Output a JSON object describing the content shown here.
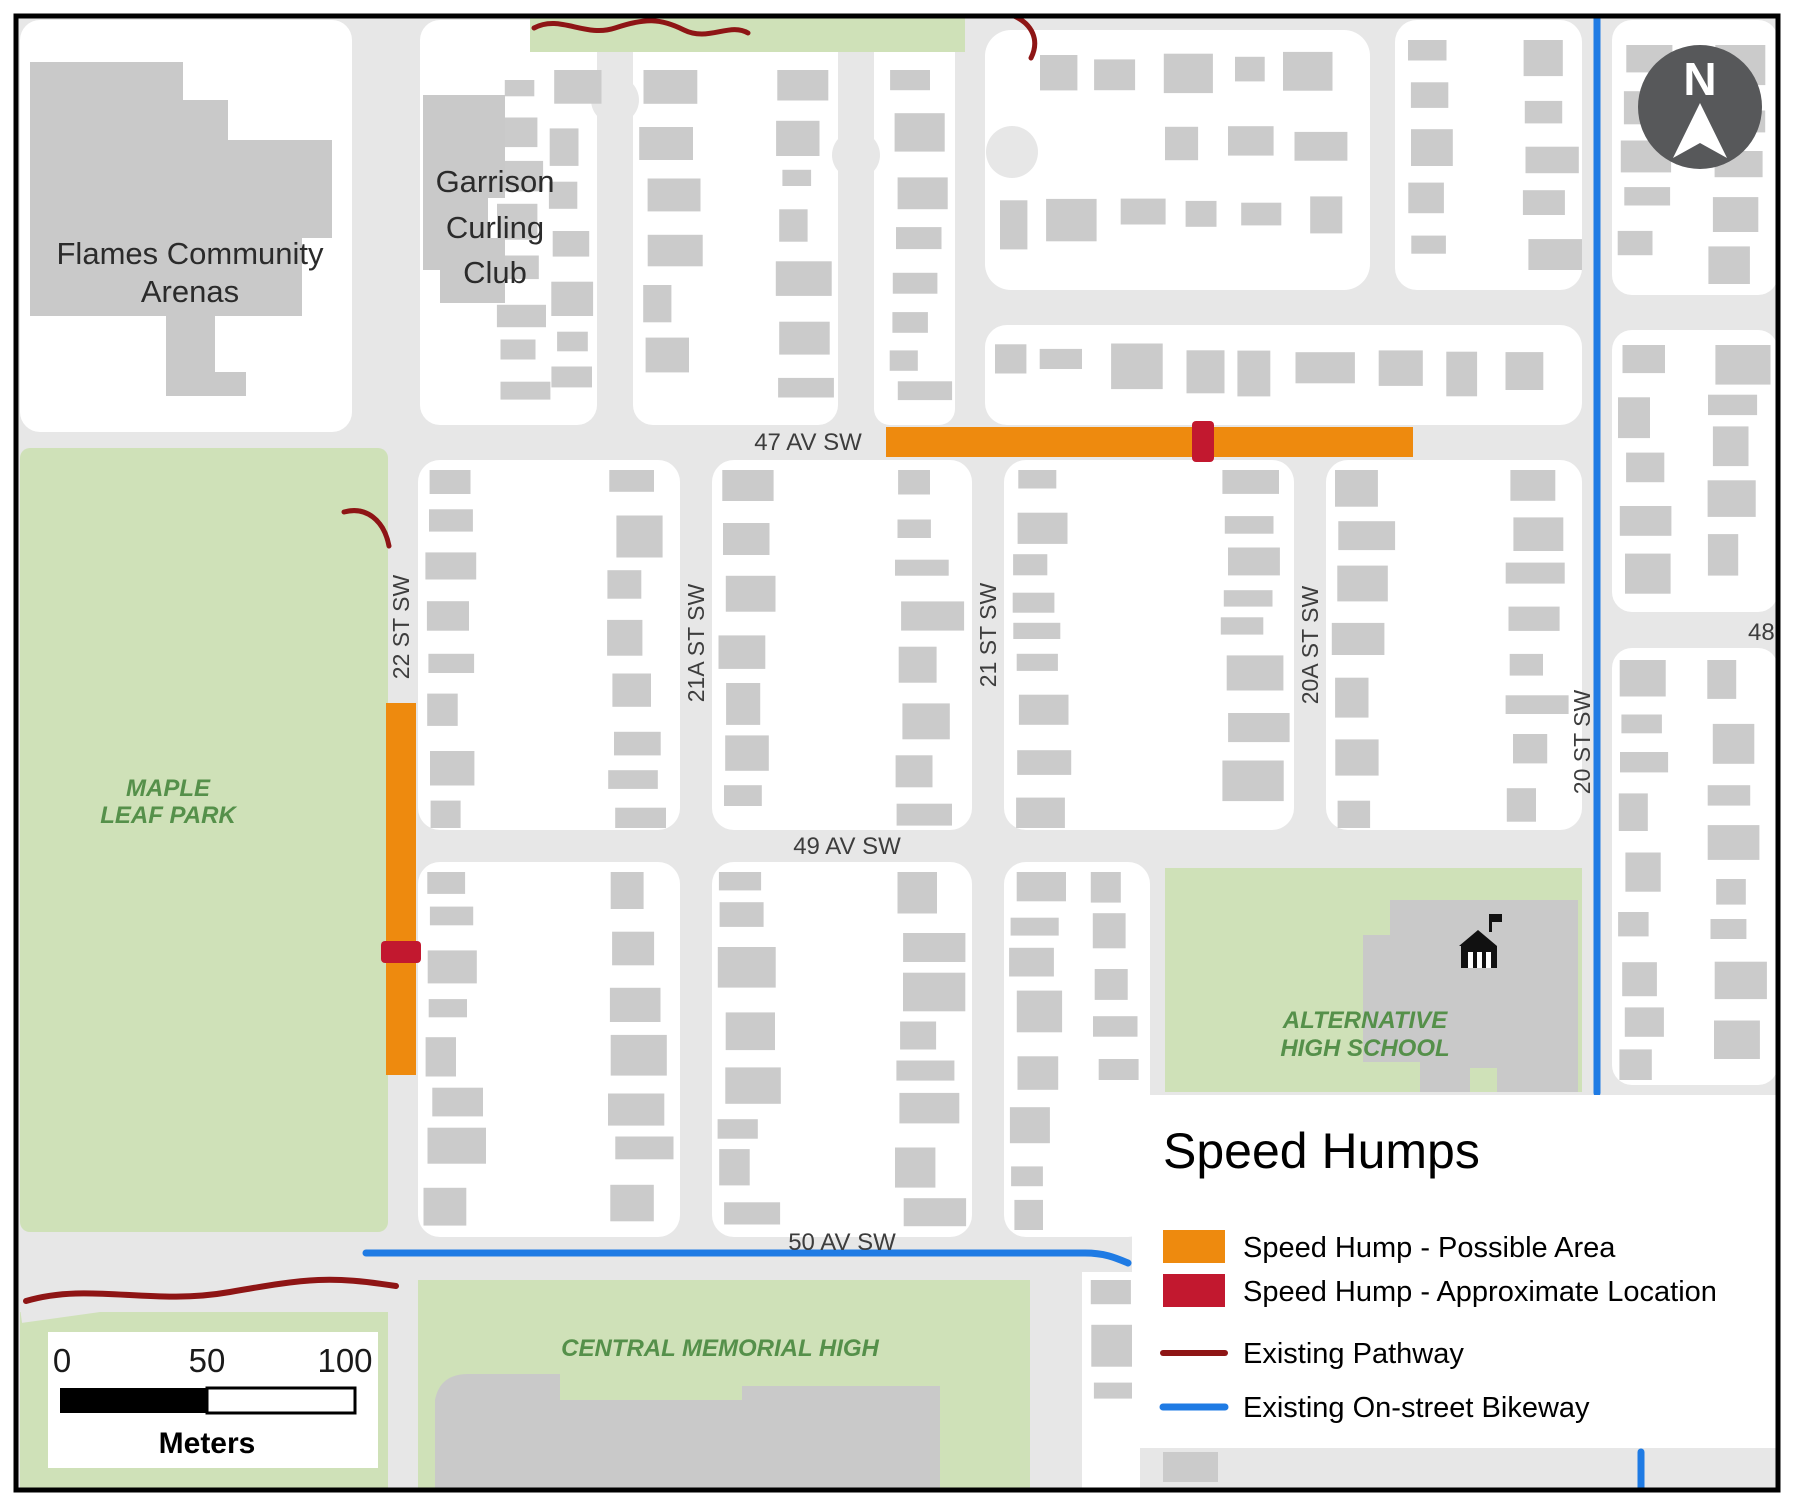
{
  "colors": {
    "road": "#e7e7e7",
    "block": "#ffffff",
    "building": "#cbcbcb",
    "green": "#cfe1b8",
    "green_text": "#55904a",
    "label": "#3d3d3d",
    "speed_hump_possible": "#ee8a0e",
    "speed_hump_location": "#c2182f",
    "pathway": "#8e1515",
    "bikeway": "#1f7be4",
    "north_circle": "#57585a"
  },
  "north": {
    "letter": "N"
  },
  "scale_bar": {
    "tick0": "0",
    "tick50": "50",
    "tick100": "100",
    "unit": "Meters"
  },
  "legend": {
    "title": "Speed Humps",
    "items": [
      {
        "label": "Speed Hump - Possible Area",
        "type": "swatch-orange"
      },
      {
        "label": "Speed Hump - Approximate Location",
        "type": "swatch-red"
      },
      {
        "label": "Existing Pathway",
        "type": "line-darkred"
      },
      {
        "label": "Existing On-street Bikeway",
        "type": "line-blue"
      }
    ]
  },
  "places": {
    "flames": {
      "line1": "Flames Community",
      "line2": "Arenas"
    },
    "garrison": {
      "line1": "Garrison",
      "line2": "Curling",
      "line3": "Club"
    },
    "maple": {
      "line1": "MAPLE",
      "line2": "LEAF PARK"
    },
    "alternative": {
      "line1": "ALTERNATIVE",
      "line2": "HIGH SCHOOL"
    },
    "central": {
      "line1": "CENTRAL MEMORIAL HIGH"
    }
  },
  "streets": {
    "av47": "47 AV SW",
    "av49": "49 AV SW",
    "av50": "50  AV SW",
    "st22": "22 ST SW",
    "st21a": "21A ST SW",
    "st21": "21 ST SW",
    "st20a": "20A ST SW",
    "st20": "20 ST SW",
    "av48_partial": "48"
  }
}
